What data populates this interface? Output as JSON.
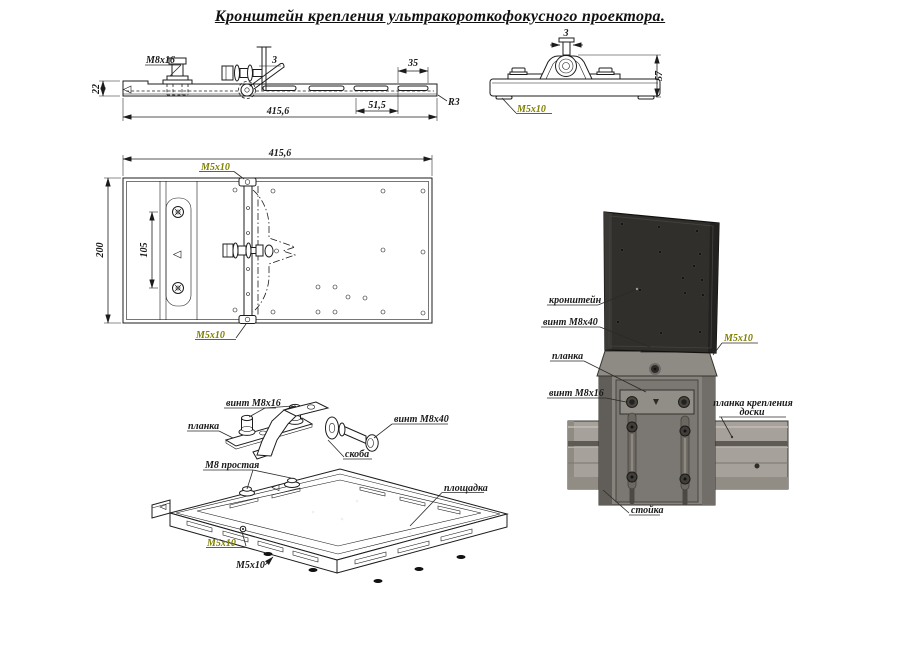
{
  "title": "Кронштейн крепления ультракороткофокусного проектора.",
  "colors": {
    "ink": "#1c1c1c",
    "olive_label": "#808000",
    "paper": "#ffffff",
    "bracket_plate_dark": "#312f2c",
    "column_gray": "#86827c",
    "rail_gray": "#a6a19a"
  },
  "views": {
    "side": {
      "thread_label": "M8x16",
      "dim_plate_thickness": "3",
      "dim_height": "22",
      "dim_slot_length": "35",
      "dim_slot_pitch": "51,5",
      "dim_length": "415,6",
      "radius_label": "R3"
    },
    "front": {
      "dim_screw": "3",
      "dim_height": "57",
      "screw_label": "M5x10"
    },
    "plan": {
      "dim_length": "415,6",
      "dim_width": "200",
      "dim_hole_pitch": "105",
      "screw_top": "M5x10",
      "screw_bottom": "M5x10"
    },
    "exploded": {
      "screw_m8x16": "винт M8x16",
      "strip": "планка",
      "screw_m8x40": "винт M8x40",
      "bracket": "скоба",
      "nut_plain": "M8 простая",
      "platform": "площадка",
      "screw_m5x10_a": "M5x10",
      "screw_m5x10_b": "M5x10"
    },
    "assembly": {
      "bracket": "кронштейн",
      "screw_m8x40": "винт M8x40",
      "screw_m5x10": "M5x10",
      "strip": "планка",
      "screw_m8x16": "винт M8x16",
      "board_strip_line1": "планка крепления",
      "board_strip_line2": "доски",
      "post": "стойка"
    }
  }
}
